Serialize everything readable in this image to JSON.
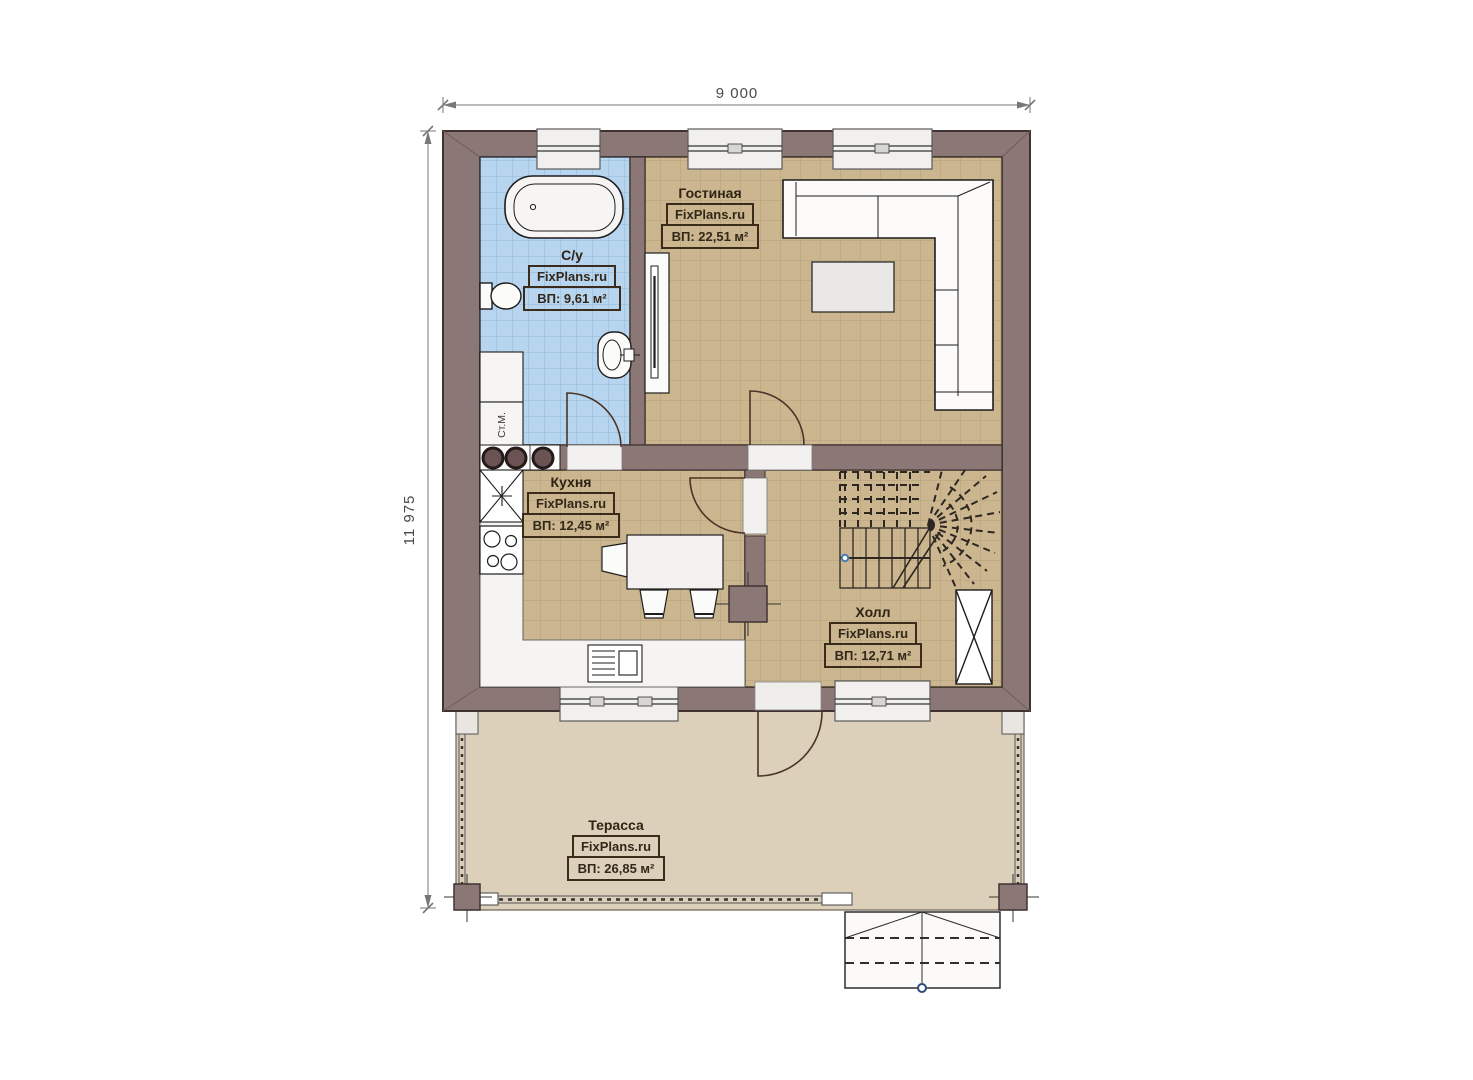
{
  "page": {
    "background": "#ffffff"
  },
  "plan": {
    "dimensions": {
      "top": "9 000",
      "left": "11 975"
    },
    "rooms": [
      {
        "key": "bathroom",
        "name": "С/у",
        "brand": "FixPlans.ru",
        "area": "ВП: 9,61 м²"
      },
      {
        "key": "living_room",
        "name": "Гостиная",
        "brand": "FixPlans.ru",
        "area": "ВП: 22,51 м²"
      },
      {
        "key": "kitchen",
        "name": "Кухня",
        "brand": "FixPlans.ru",
        "area": "ВП: 12,45 м²"
      },
      {
        "key": "hall",
        "name": "Холл",
        "brand": "FixPlans.ru",
        "area": "ВП: 12,71 м²"
      },
      {
        "key": "terrace",
        "name": "Терасса",
        "brand": "FixPlans.ru",
        "area": "ВП: 26,85 м²"
      }
    ],
    "labels": {
      "washing_machine": "Ст.М."
    },
    "colors": {
      "wall": "#8b7876",
      "wall_outline": "#3f3230",
      "floor_tile_tan": "#cbb68f",
      "floor_tile_blue": "#b7d5ef",
      "terrace_floor": "#dcd0bb",
      "window_fill": "#f1f0ee",
      "label_text": "#2f2315"
    }
  }
}
